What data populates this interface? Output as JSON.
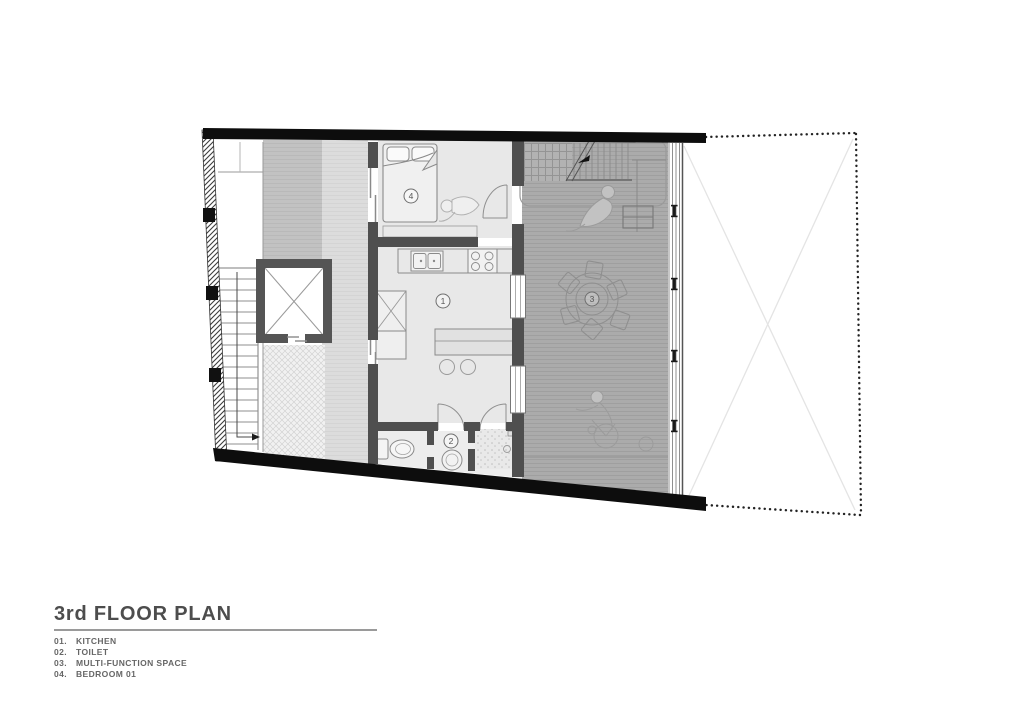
{
  "title_block": {
    "title": "3rd FLOOR PLAN",
    "title_color": "#4d4d4d",
    "underline_color": "#9a9a9a"
  },
  "legend": {
    "text_color": "#666666",
    "items": [
      {
        "number": "01.",
        "label": "KITCHEN"
      },
      {
        "number": "02.",
        "label": "TOILET"
      },
      {
        "number": "03.",
        "label": "MULTI-FUNCTION SPACE"
      },
      {
        "number": "04.",
        "label": "BEDROOM 01"
      }
    ]
  },
  "plan": {
    "rooms": [
      {
        "number": "1",
        "name": "KITCHEN"
      },
      {
        "number": "2",
        "name": "TOILET"
      },
      {
        "number": "3",
        "name": "MULTI-FUNCTION SPACE"
      },
      {
        "number": "4",
        "name": "BEDROOM 01"
      }
    ],
    "colors": {
      "boundary_wall": "#0d0d0d",
      "interior_wall": "#4f4f4f",
      "elevator_wall": "#555555",
      "floor_light": "#e8e8e8",
      "floor_medium_band": "#c2c2c2",
      "floor_light_band": "#dcdcdc",
      "deck_floor": "#ababab",
      "furniture_line": "#8a8a8a",
      "void_cross": "#e4e4e4",
      "dotted_boundary": "#222222"
    }
  }
}
